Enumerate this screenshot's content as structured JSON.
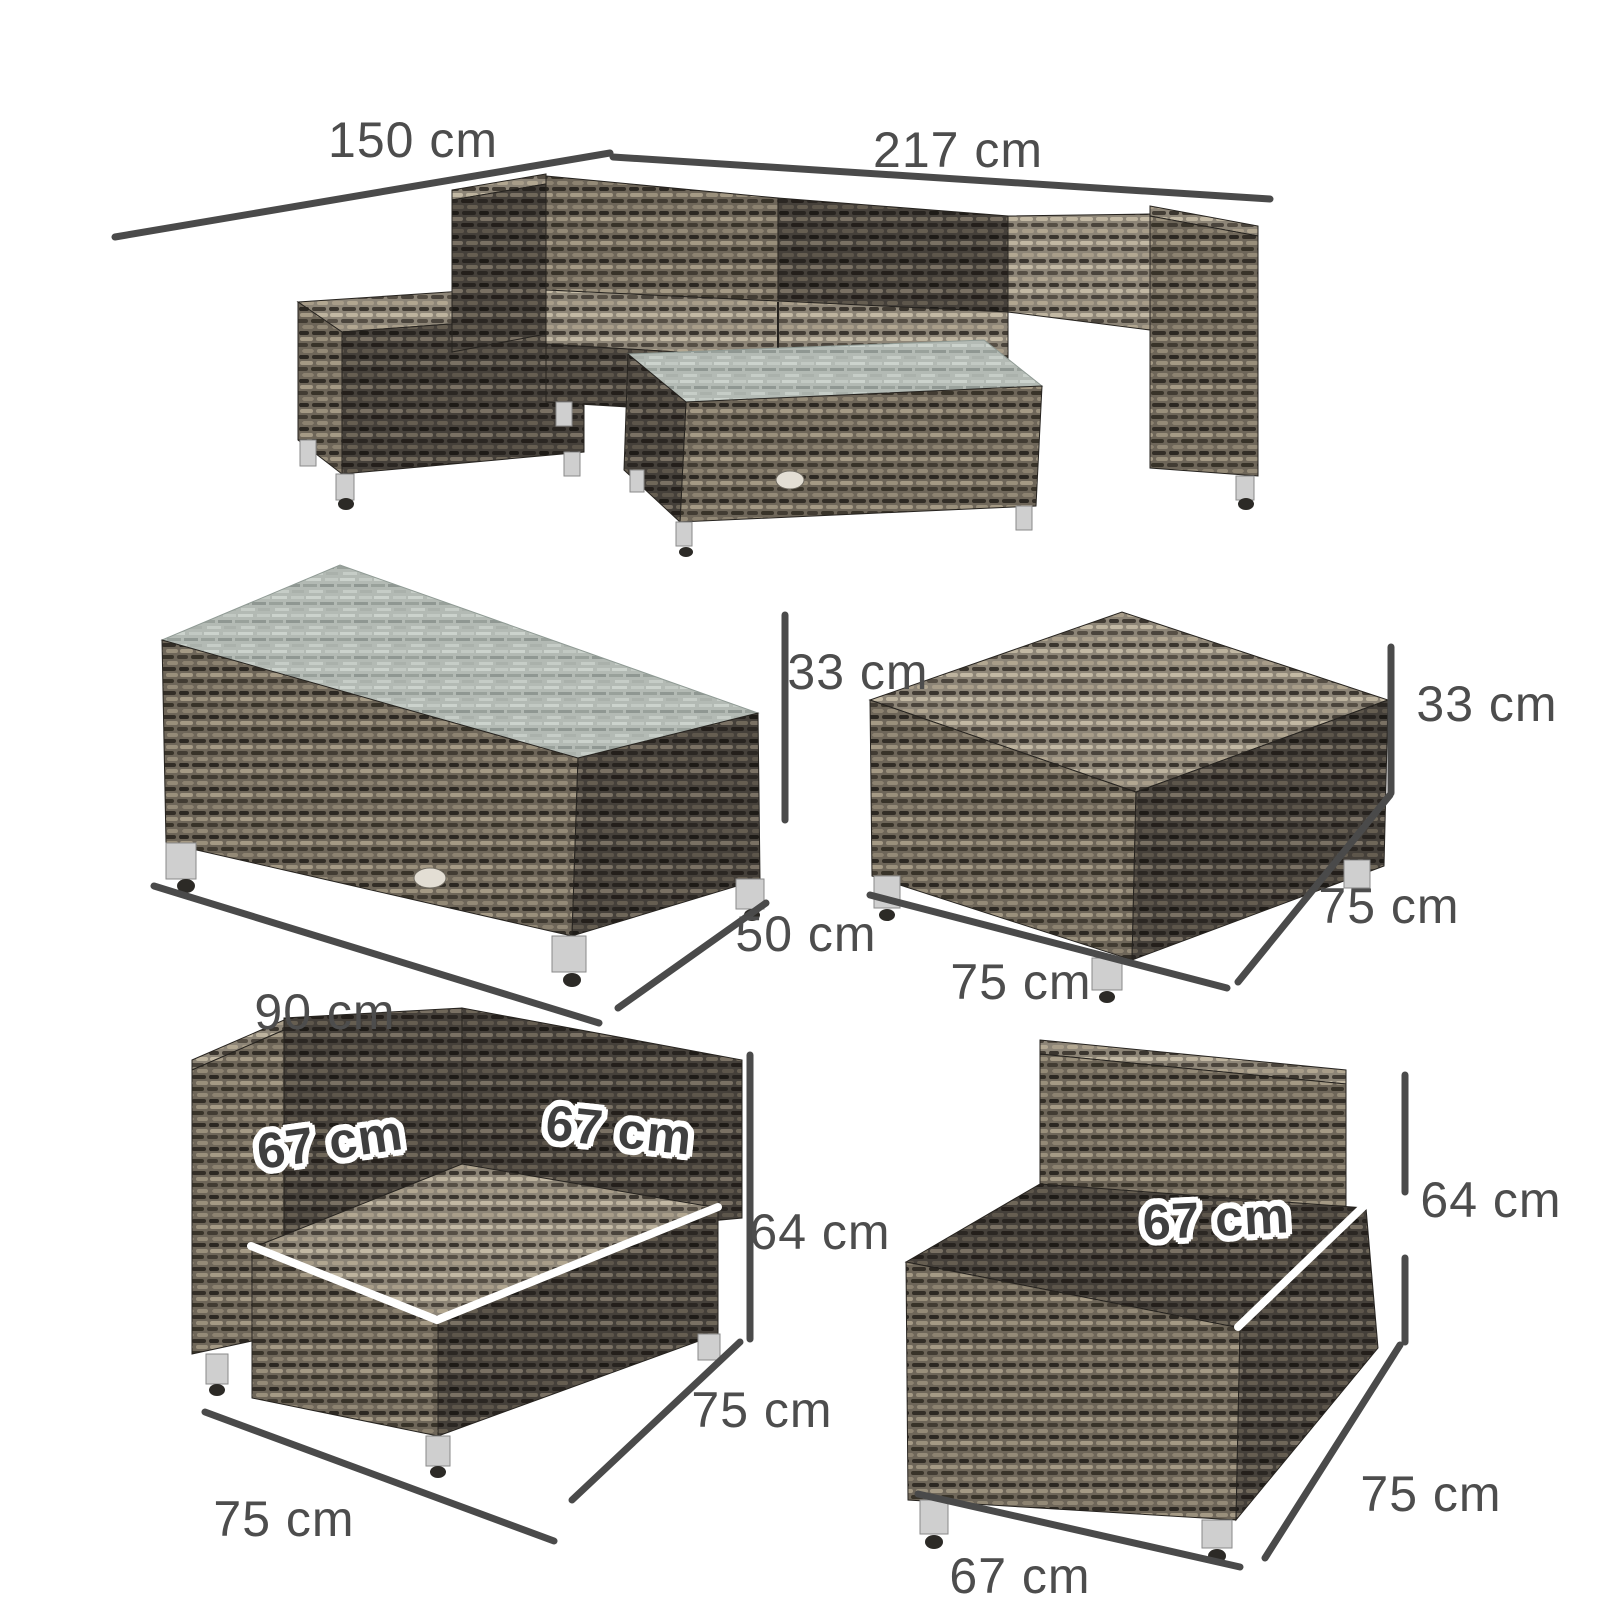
{
  "image_type": "product dimension diagram",
  "subject": "grey rattan outdoor sofa furniture set with measurement annotations",
  "colors": {
    "background": "#ffffff",
    "dimension_line": "#4a4a4a",
    "label_text": "#4d4d4d",
    "seat_label_fill": "#3f3f3f",
    "seat_label_outline": "#ffffff",
    "seat_dimension_line": "#ffffff",
    "rattan_dark": "#3a352e",
    "rattan_mid": "#6e6659",
    "rattan_light": "#8d8577",
    "glass_top": "#b3bab4",
    "leg_silver": "#cfcfcf"
  },
  "furniture": {
    "sofa_set": {
      "name": "corner sofa set with chaise and coffee table",
      "label_depth": "150 cm",
      "label_width": "217 cm"
    },
    "coffee_table": {
      "name": "glass top coffee table",
      "height": "33 cm",
      "depth": "50 cm",
      "width": "90 cm"
    },
    "ottoman": {
      "name": "footstool ottoman",
      "height": "33 cm",
      "depth": "75 cm",
      "width": "75 cm"
    },
    "corner_chair": {
      "name": "corner sofa chair",
      "seat_depth": "67 cm",
      "seat_width": "67 cm",
      "height": "64 cm",
      "depth": "75 cm",
      "width": "75 cm"
    },
    "armless_chair": {
      "name": "armless middle sofa chair",
      "seat_width": "67 cm",
      "height": "64 cm",
      "depth": "75 cm",
      "width": "67 cm"
    }
  }
}
